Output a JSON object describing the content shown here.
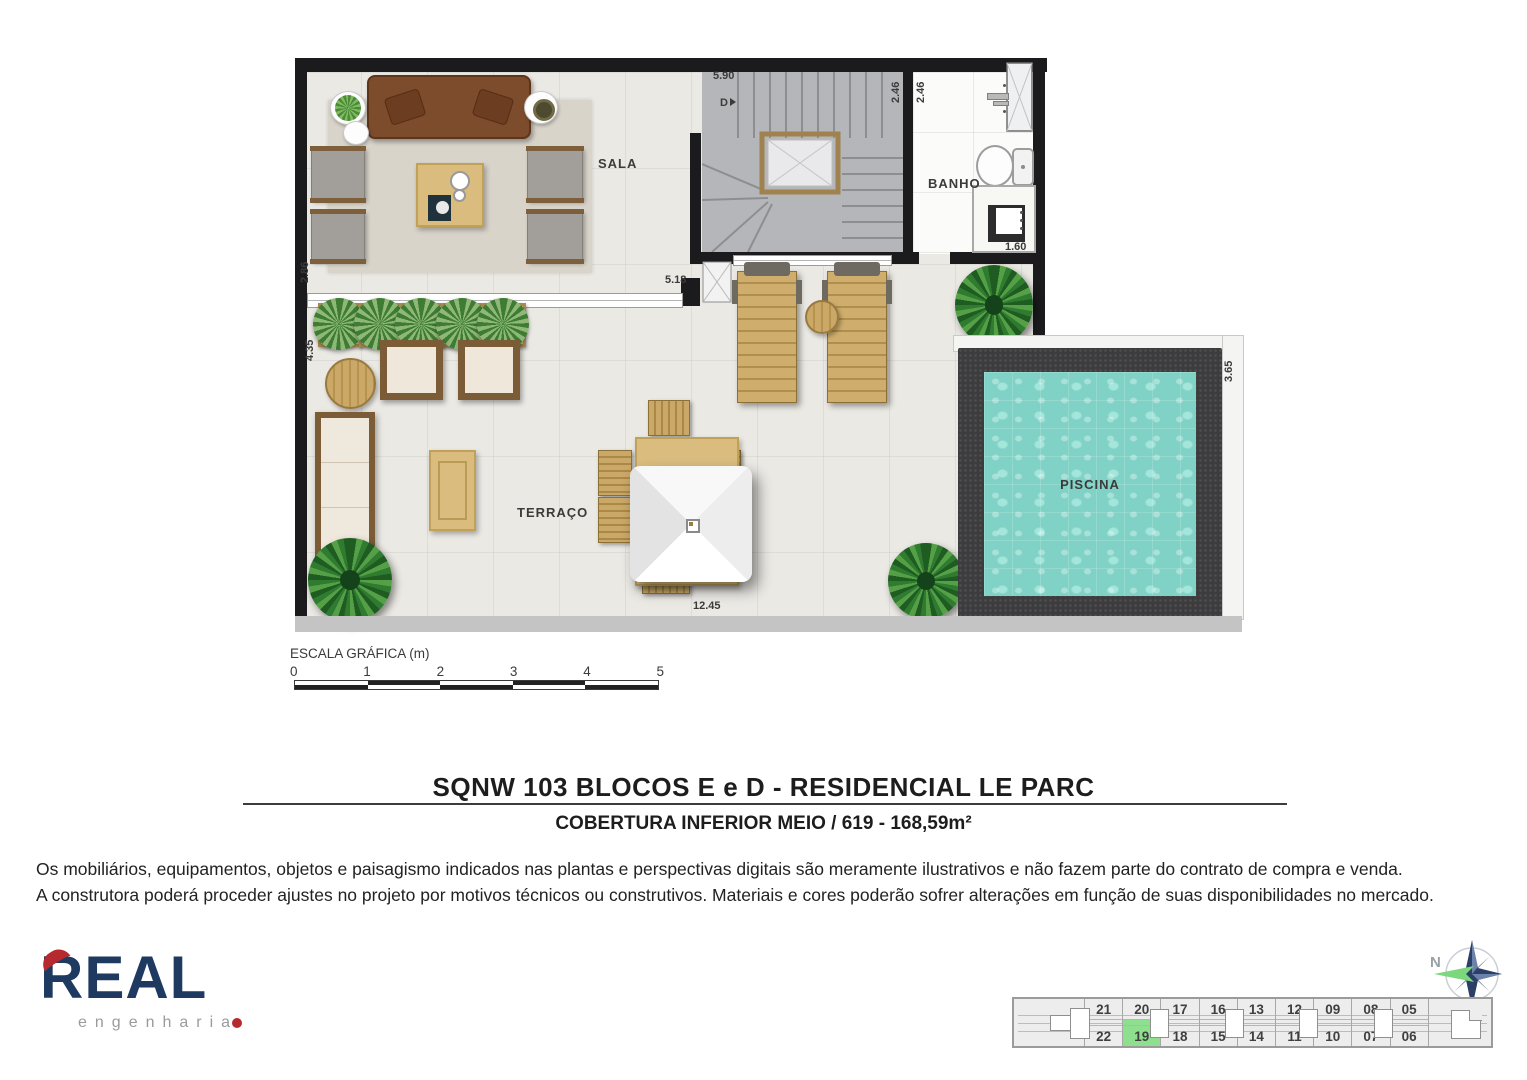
{
  "plan": {
    "labels": {
      "sala": "SALA",
      "banho": "BANHO",
      "terraco": "TERRAÇO",
      "piscina": "PISCINA"
    },
    "stair_direction": "D",
    "dims": {
      "top_width": "5.90",
      "stair_side": "2.46",
      "banho_side": "2.46",
      "banho_width": "1.60",
      "sala_height": "2.86",
      "sala_width": "5.18",
      "terrace_height": "4.35",
      "terrace_width": "12.45",
      "pool_side": "3.65"
    }
  },
  "scalebar": {
    "title": "ESCALA GRÁFICA (m)",
    "ticks": [
      "0",
      "1",
      "2",
      "3",
      "4",
      "5"
    ]
  },
  "header": {
    "title": "SQNW 103 BLOCOS E e D -  RESIDENCIAL LE PARC",
    "subtitle": "COBERTURA INFERIOR MEIO / 619 - 168,59m²"
  },
  "disclaimer": {
    "line1": "Os mobiliários, equipamentos, objetos e paisagismo indicados nas plantas e perspectivas digitais são meramente ilustrativos e não fazem parte do contrato de compra e venda.",
    "line2": "A construtora poderá proceder ajustes no projeto por motivos técnicos ou construtivos. Materiais e cores poderão sofrer alterações em função de suas disponibilidades no mercado."
  },
  "brand": {
    "name": "REAL",
    "tagline": "engenharia"
  },
  "compass": {
    "north": "N"
  },
  "keyplan": {
    "top_row": [
      "21",
      "20",
      "17",
      "16",
      "13",
      "12",
      "09",
      "08",
      "05"
    ],
    "bottom_row": [
      "22",
      "19",
      "18",
      "15",
      "14",
      "11",
      "10",
      "07",
      "06"
    ],
    "selected_unit": "19"
  },
  "colors": {
    "brand_navy": "#1e3a60",
    "brand_red": "#b5292f",
    "keyplan_highlight": "#8ee08f",
    "pool_water": "#7fd2c5",
    "wall": "#1b1b1d"
  }
}
